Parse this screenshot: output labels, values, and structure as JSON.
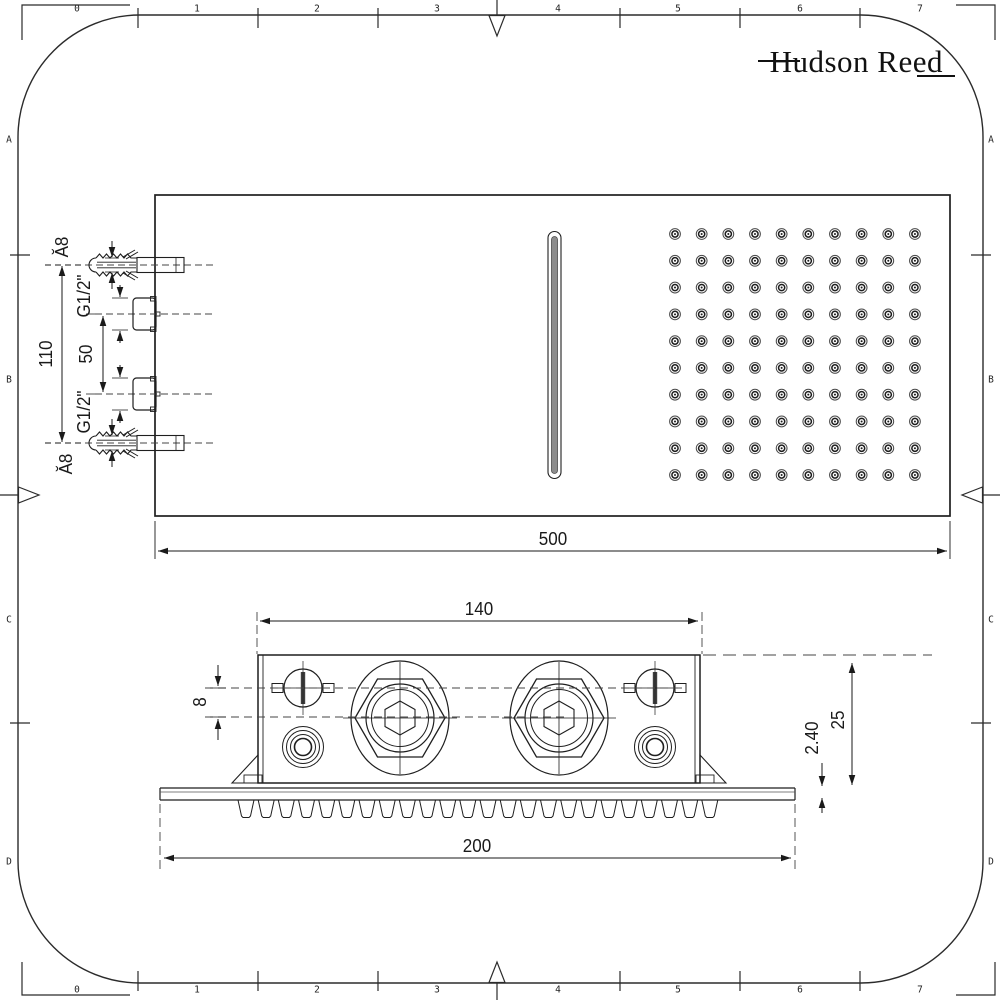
{
  "brand": {
    "logo_text": "Hudson Reed"
  },
  "frame": {
    "top_ruler": [
      "0",
      "1",
      "2",
      "3",
      "4",
      "5",
      "6",
      "7"
    ],
    "bottom_ruler": [
      "0",
      "1",
      "2",
      "3",
      "4",
      "5",
      "6",
      "7"
    ],
    "left_ruler": [
      "A",
      "B",
      "C",
      "D"
    ],
    "right_ruler": [
      "A",
      "B",
      "C",
      "D"
    ]
  },
  "plan_view": {
    "overall_width": "500",
    "anchor_hole_top": "Ă8",
    "anchor_hole_bottom": "Ă8",
    "anchor_spacing": "110",
    "inlet_spacing": "50",
    "inlet_thread_top": "G1/2\"",
    "inlet_thread_bottom": "G1/2\"",
    "nozzle_grid": {
      "rows": 10,
      "cols": 10
    }
  },
  "side_view": {
    "mount_width": "140",
    "overall_depth": "200",
    "inlet_offset": "8",
    "body_height": "25",
    "plate_thickness": "2.40",
    "teeth_count": 24
  },
  "colors": {
    "line": "#1f1f1f",
    "slot_fill": "#8d8d8d"
  }
}
